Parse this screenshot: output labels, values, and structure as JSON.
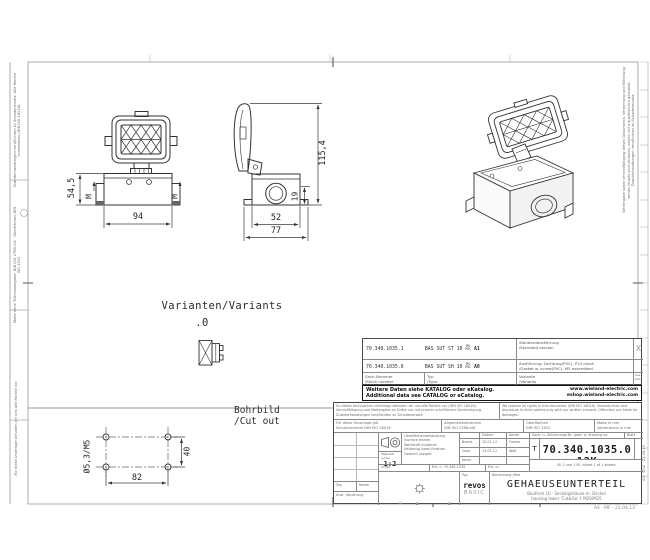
{
  "sheet": {
    "footer_right": "A4 · MF · 23.04.13"
  },
  "margins": {
    "left_1": "Zuwiderhandlungen verpflichten zu Schadenersatz. Alle Rechte vorbehalten (DIN ISO 16016).",
    "left_2": "Maße ohne Toleranzangabe: DIN ISO 2768-mK · Oberflächen DIN ISO 1302",
    "left_3": "Für diese Unterlage behalten wir uns alle Rechte vor.",
    "right_1": "Weitergabe sowie Vervielfältigung dieses Dokuments, Verwertung und Mitteilung seines Inhalts sind verboten, soweit nicht ausdrücklich gestattet. Zuwiderhandlungen verpflichten zu Schadenersatz.",
    "right_2": "A3 · W10 · 23.04.13"
  },
  "drawing": {
    "variants_heading": "Varianten/Variants",
    "variants_value": ".0",
    "cutout_heading_1": "Bohrbild",
    "cutout_heading_2": "/Cut out",
    "dims": {
      "front_height": "54,5",
      "front_m_left": "M",
      "front_m_right": "M",
      "front_width": "94",
      "side_height": "115,4",
      "side_foot": "19",
      "side_inner_width": "52",
      "side_outer_width": "77",
      "cutout_width": "82",
      "cutout_height": "40",
      "cutout_hole": "Ø5,3/M5"
    }
  },
  "variants_table": {
    "rows": [
      {
        "stock": "70.340.1035.1",
        "type": "BAS SUT ST 10",
        "frac_top": "MS",
        "frac_bot": "MIC",
        "variant": "A1",
        "desc_1": "Standardausführung",
        "desc_2": "/Standard version",
        "mark": "X"
      },
      {
        "stock": "70.340.1035.0",
        "type": "BAS SUT SH 10",
        "frac_top": "MS",
        "frac_bot": "MIC",
        "variant": "A0",
        "desc_1": "Ausführung: Dichtung(PVC), P14 mont.",
        "desc_2": "/Gasket w. screw(PVC), M5 assembled",
        "mark": ""
      }
    ],
    "header": {
      "col1_1": "Sach-Nummer",
      "col1_2": "/Stock number",
      "col2_1": "Typ",
      "col2_2": "/Type",
      "col3_1": "Variante",
      "col3_2": "/Variants",
      "col4_1": "Aus-",
      "col4_2": "wahl"
    },
    "notice_1": "Weitere Daten siehe KATALOG oder eKatalog.",
    "notice_2": "Additional data see CATALOG or eCatalog.",
    "url_1": "www.wieland-electric.com",
    "url_2": "eshop.wieland-electric.com"
  },
  "titleblock": {
    "para_de": "Zu dieser technischen Unterlage behalten wir uns alle Rechte vor (DIN ISO 16016). Vervielfältigung und Weitergabe an Dritte nur mit unserer schriftlichen Genehmigung. Zuwiderhandlungen verpflichten zu Schadenersatz.",
    "para_en": "We reserve all rights in this document (DIN ISO 16016). Reproduction and disclosure to third parties only with our written consent. Offenders are liable for damages.",
    "cells": {
      "doc_1": "Für diese Unterlage gilt",
      "doc_2": "Schutzvermerk DIN ISO 16016",
      "tol_1": "Allgemeintoleranzen",
      "tol_2": "DIN ISO 2768-mK",
      "surf_1": "Oberflächen",
      "surf_2": "DIN ISO 1302",
      "mm_1": "Maße in mm",
      "mm_2": "/dimensions in mm"
    },
    "scale_label_1": "Maßstab",
    "scale_label_2": "/scale",
    "scale": "1:2",
    "mat_1": "Oberflächenbehandlung /surface treatm.",
    "mat_2": "Werkstoff /material",
    "mat_3": "Halbzeug /semi-finished",
    "mat_4": "Gewicht /weight",
    "approval": {
      "datum": "Datum",
      "name": "Name",
      "r1_label": "Bearb.",
      "r1_datum": "12.01.12",
      "r1_name": "Franke",
      "r2_label": "Gepr.",
      "r2_datum": "13.01.12",
      "r2_name": "Wolf",
      "r3_label": "Norm",
      "r3_datum": "",
      "r3_name": ""
    },
    "docno_label": "Sach- u. Zeichnungs-Nr. /part- a. drawing no.",
    "blatt": "Blatt",
    "t": "T",
    "docno": "70.340.1035.0 13K",
    "sheet_line": "Bl. 1 von 1 Bl. /sheet 1 of 1 sheets",
    "urspr": "Urspr.",
    "ers_f": "Ers. f.: 70.340.1035",
    "ers_d": "Ers. d.:",
    "rev": {
      "tag": "Tag",
      "name": "Name",
      "zust_1": "Zust. /Änderung"
    },
    "brand": "wieland",
    "brand_sub_1": "® eingetragenes Warenzeichen",
    "brand_sub_2": "/registered trademark",
    "typ_label": "Typ",
    "series_1": "revos",
    "series_2": "BASIC",
    "title_label": "Benennung /title",
    "title": "GEHAEUSEUNTERTEIL",
    "subtitle_1": "Bauform 10 · Sockelgehäuse m. Deckel",
    "subtitle_2": "housing lower 'Cut&Go' f. M20/M25"
  }
}
